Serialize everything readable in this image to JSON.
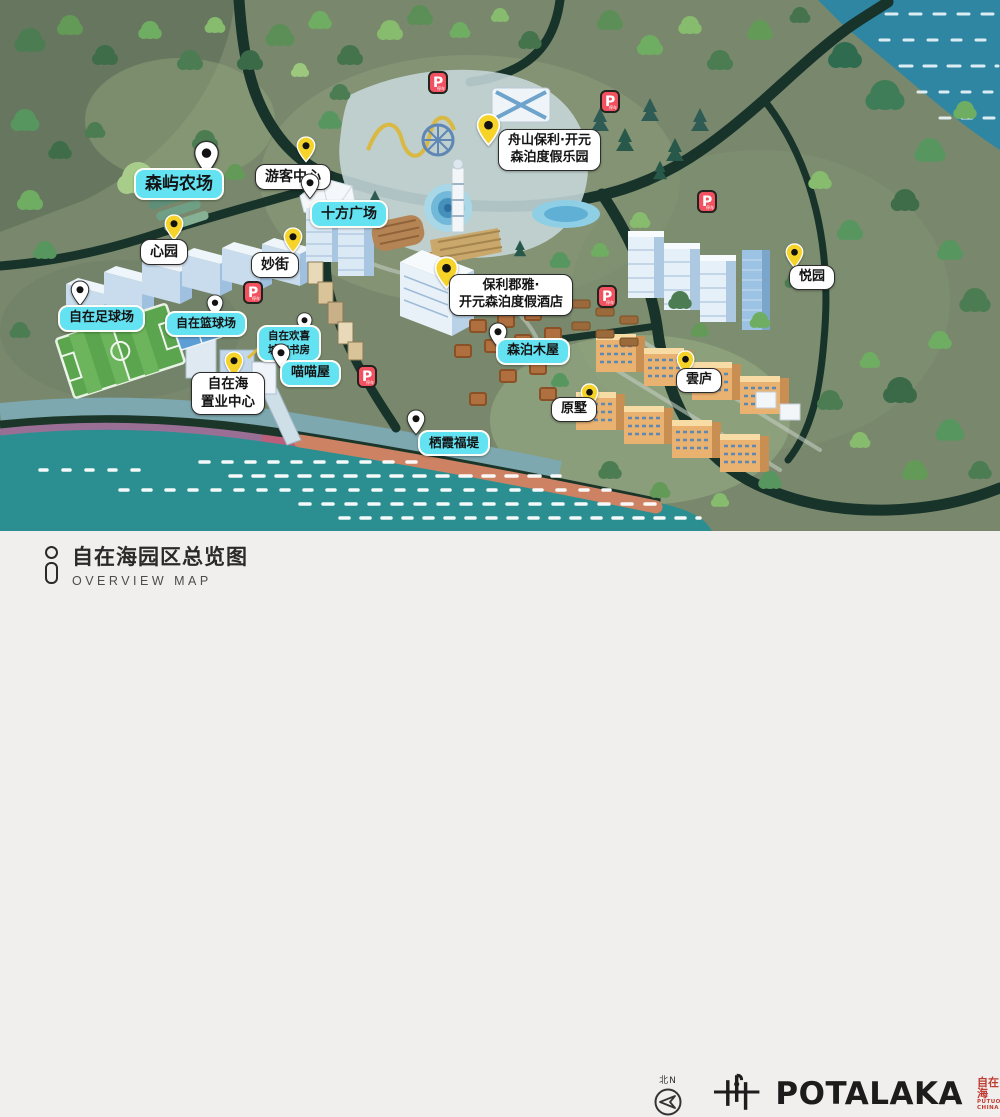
{
  "colors": {
    "label-cyan": "#63e2f2",
    "pin-yellow": "#f6d329",
    "pin-white": "#ffffff",
    "parking-red": "#f2525f",
    "seal-red": "#bf3a2e",
    "footer-bg": "#f1efee",
    "sea-teal": "#2b8f91",
    "water-blue": "#2e86a3",
    "road-green": "#17332a",
    "terrain-green": "#79886c"
  },
  "map": {
    "pois": [
      {
        "id": "senyu-farm",
        "label": "森屿农场",
        "box": "cyan",
        "pin": "white",
        "box_x": 134,
        "box_y": 168,
        "pin_x": 193,
        "pin_y": 140,
        "ps": 1.35,
        "fs": 17
      },
      {
        "id": "visitor-center",
        "label": "游客中心",
        "box": "white",
        "pin": "yellow",
        "box_x": 255,
        "box_y": 164,
        "pin_x": 296,
        "pin_y": 136,
        "ps": 1,
        "fs": 14
      },
      {
        "id": "shifang-square",
        "label": "十方广场",
        "box": "cyan",
        "pin": "white",
        "box_x": 310,
        "box_y": 200,
        "pin_x": 300,
        "pin_y": 173,
        "ps": 1,
        "fs": 14
      },
      {
        "id": "zhoushan-resort-park",
        "label": "舟山保利·开元\n森泊度假乐园",
        "box": "white",
        "pin": "yellow",
        "box_x": 498,
        "box_y": 129,
        "pin_x": 476,
        "pin_y": 113,
        "ps": 1.25,
        "fs": 13
      },
      {
        "id": "xin-garden",
        "label": "心园",
        "box": "white",
        "pin": "yellow",
        "box_x": 140,
        "box_y": 239,
        "pin_x": 164,
        "pin_y": 214,
        "ps": 1,
        "fs": 14
      },
      {
        "id": "miao-street",
        "label": "妙街",
        "box": "white",
        "pin": "yellow",
        "box_x": 251,
        "box_y": 252,
        "pin_x": 283,
        "pin_y": 227,
        "ps": 1,
        "fs": 14
      },
      {
        "id": "resort-hotel",
        "label": "保利郡雅·\n开元森泊度假酒店",
        "box": "white",
        "pin": "yellow",
        "box_x": 449,
        "box_y": 274,
        "pin_x": 434,
        "pin_y": 256,
        "ps": 1.25,
        "fs": 13
      },
      {
        "id": "football-field",
        "label": "自在足球场",
        "box": "cyan",
        "pin": "white",
        "box_x": 58,
        "box_y": 305,
        "pin_x": 70,
        "pin_y": 280,
        "ps": 1,
        "fs": 13
      },
      {
        "id": "basketball-court",
        "label": "自在篮球场",
        "box": "cyan",
        "pin": "white",
        "box_x": 165,
        "box_y": 311,
        "pin_x": 206,
        "pin_y": 294,
        "ps": 0.9,
        "fs": 12
      },
      {
        "id": "city-bookstore",
        "label": "自在欢喜\n城市书房",
        "box": "cyan",
        "pin": "white",
        "box_x": 257,
        "box_y": 325,
        "pin_x": 296,
        "pin_y": 312,
        "ps": 0.85,
        "fs": 10.5
      },
      {
        "id": "cat-house",
        "label": "喵喵屋",
        "box": "cyan",
        "pin": "white",
        "box_x": 280,
        "box_y": 360,
        "pin_x": 271,
        "pin_y": 343,
        "ps": 1,
        "fs": 13
      },
      {
        "id": "sales-center",
        "label": "自在海\n置业中心",
        "box": "white",
        "pin": "yellow",
        "box_x": 191,
        "box_y": 372,
        "pin_x": 224,
        "pin_y": 351,
        "ps": 1,
        "fs": 13.5
      },
      {
        "id": "senpo-cabins",
        "label": "森泊木屋",
        "box": "cyan",
        "pin": "white",
        "box_x": 496,
        "box_y": 338,
        "pin_x": 488,
        "pin_y": 322,
        "ps": 1,
        "fs": 13
      },
      {
        "id": "qixia-dike",
        "label": "栖霞福堤",
        "box": "cyan",
        "pin": "white",
        "box_x": 418,
        "box_y": 430,
        "pin_x": 406,
        "pin_y": 409,
        "ps": 1,
        "fs": 12.5
      },
      {
        "id": "yuan-villa",
        "label": "原墅",
        "box": "white",
        "pin": "yellow",
        "box_x": 551,
        "box_y": 397,
        "pin_x": 580,
        "pin_y": 383,
        "ps": 0.95,
        "fs": 13
      },
      {
        "id": "yun-lodge",
        "label": "雲庐",
        "box": "white",
        "pin": "yellow",
        "box_x": 676,
        "box_y": 368,
        "pin_x": 676,
        "pin_y": 350,
        "ps": 0.95,
        "fs": 13
      },
      {
        "id": "yue-garden",
        "label": "悦园",
        "box": "white",
        "pin": "yellow",
        "box_x": 789,
        "box_y": 265,
        "pin_x": 785,
        "pin_y": 243,
        "ps": 0.95,
        "fs": 13
      }
    ],
    "parking": {
      "glyph": "P",
      "sub": "停车",
      "spots": [
        {
          "x": 428,
          "y": 71
        },
        {
          "x": 600,
          "y": 90
        },
        {
          "x": 697,
          "y": 190
        },
        {
          "x": 597,
          "y": 285
        },
        {
          "x": 243,
          "y": 281
        },
        {
          "x": 357,
          "y": 365
        }
      ]
    }
  },
  "footer": {
    "title": "自在海园区总览图",
    "subtitle": "OVERVIEW MAP",
    "compass_label": "北N",
    "brand": {
      "wordmark": "POTALAKA",
      "seal": "自在海",
      "seal_sub": "PUTUO\nCHINA"
    }
  }
}
